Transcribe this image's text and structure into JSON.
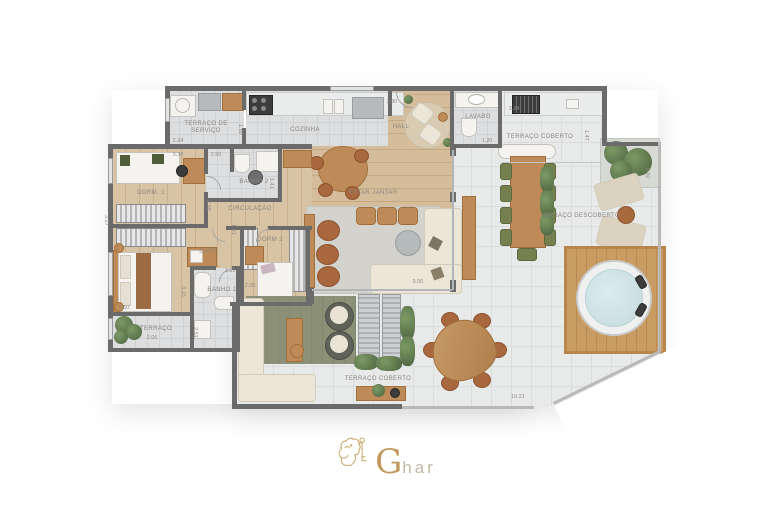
{
  "palette": {
    "wall": "#6b6b6b",
    "wood_floor": "#d9c3a5",
    "tile_floor": "#dcdee0",
    "terrace_floor": "#e8e9e9",
    "rug_green": "#8b9077",
    "accent_gold": "#c39a5d"
  },
  "rooms": {
    "terraco_servico": {
      "label": "TERRAÇO DE SERVIÇO",
      "dim_w": "2.34",
      "dim_h": "1.80"
    },
    "cozinha": {
      "label": "COZINHA",
      "dim_w": "2.90"
    },
    "hall": {
      "label": "HALL"
    },
    "lavabo": {
      "label": "LAVABO",
      "dim_w": "1.20"
    },
    "terraco_coberto_top": {
      "label": "TERRAÇO COBERTO",
      "dim_w": "3.34",
      "dim_h": "1.47"
    },
    "terraco_descoberto": {
      "label": "TERRAÇO DESCOBERTO",
      "dim_h": "6.92",
      "dim_w": "10.21"
    },
    "estar_jantar": {
      "label": "ESTAR JANTAR",
      "dim_w": "5.50"
    },
    "dorm1": {
      "label": "DORM. 1",
      "dim_w": "3.30",
      "dim_h": "3.27"
    },
    "banho2": {
      "label": "BANHO 2",
      "dim_w": "2.50",
      "dim_h": "1.41"
    },
    "circulacao": {
      "label": "CIRCULAÇÃO",
      "dim_h": "2.98"
    },
    "dorm2": {
      "label": "DORM 2",
      "dim_w": "2.20",
      "dim_h": "1.91"
    },
    "suite": {
      "label": "SUÍTE",
      "dim_w": "2.60",
      "dim_h": "3.15"
    },
    "banho1": {
      "label": "BANHO 1",
      "dim_w": "1.51",
      "dim_h": "2.51"
    },
    "terraco_pequeno": {
      "label": "TERRAÇO",
      "dim_w": "2.06"
    },
    "terraco_coberto_bottom": {
      "label": "TERRAÇO COBERTO"
    }
  },
  "logo": {
    "initial": "G",
    "rest": "har"
  }
}
